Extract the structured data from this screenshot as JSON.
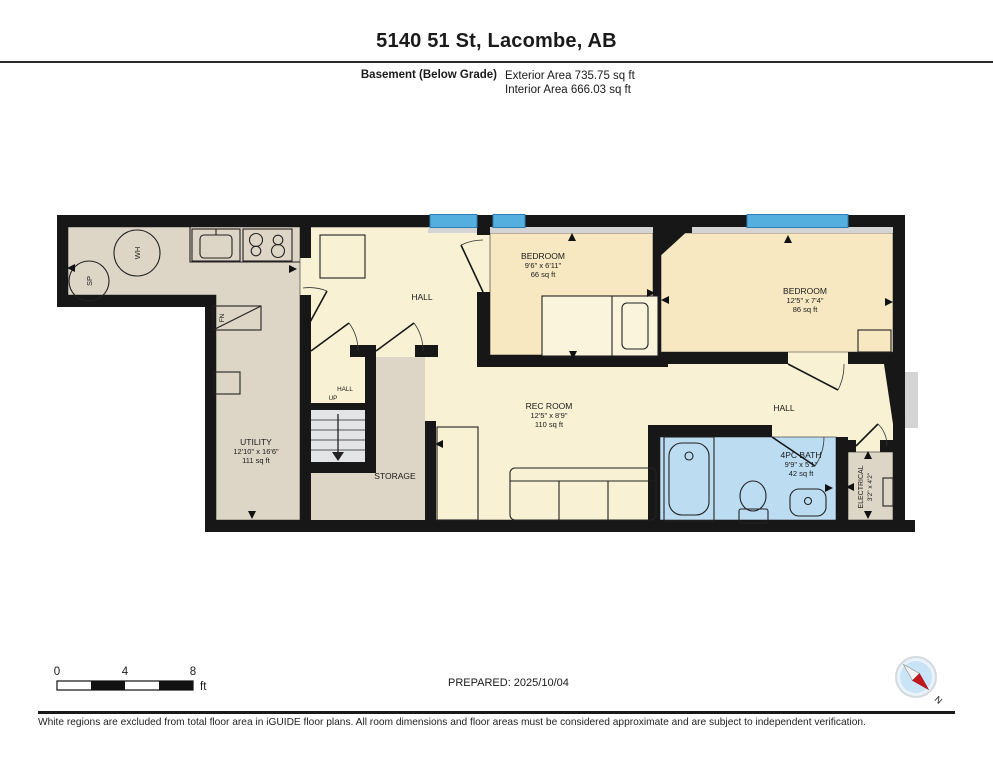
{
  "header": {
    "title": "5140 51 St, Lacombe, AB",
    "floor": "Basement (Below Grade)",
    "exterior": "Exterior Area 735.75 sq ft",
    "interior": "Interior Area 666.03 sq ft"
  },
  "rooms": {
    "utility": {
      "name": "UTILITY",
      "dims": "12'10\" x 16'6\"",
      "area": "111 sq ft"
    },
    "bedroom1": {
      "name": "BEDROOM",
      "dims": "9'6\" x 6'11\"",
      "area": "66 sq ft"
    },
    "bedroom2": {
      "name": "BEDROOM",
      "dims": "12'5\" x 7'4\"",
      "area": "86 sq ft"
    },
    "rec_room": {
      "name": "REC ROOM",
      "dims": "12'5\" x 8'9\"",
      "area": "110 sq ft"
    },
    "bath": {
      "name": "4PC BATH",
      "dims": "9'9\" x 5'1\"",
      "area": "42 sq ft"
    },
    "electrical": {
      "name": "ELECTRICAL",
      "dims": "3'2\" x 4'2\""
    },
    "storage": {
      "name": "STORAGE"
    },
    "hall_main": {
      "name": "HALL"
    },
    "hall_right": {
      "name": "HALL"
    },
    "hall_stairs": {
      "name": "HALL"
    }
  },
  "fixtures": {
    "water_heater": "WH",
    "sump_pump": "SP",
    "furnace": "FN",
    "stairs_direction": "UP"
  },
  "scale_bar": {
    "t0": "0",
    "t4": "4",
    "t8": "8",
    "unit": "ft"
  },
  "prepared": "PREPARED: 2025/10/04",
  "compass": {
    "north": "N"
  },
  "footer": "White regions are excluded from total floor area in iGUIDE floor plans. All room dimensions and floor areas must be considered approximate and are subject to independent verification.",
  "colors": {
    "wall": "#171717",
    "tan": "#ddd5c6",
    "hall_yellow": "#f9f1d3",
    "bedroom_yellow": "#f7e8c2",
    "bath_blue": "#bcdcf2",
    "window_blue": "#54aede",
    "sill_gray": "#d4d4d4",
    "stair_gray": "#e3e4e6",
    "compass_red": "#c4161c"
  }
}
